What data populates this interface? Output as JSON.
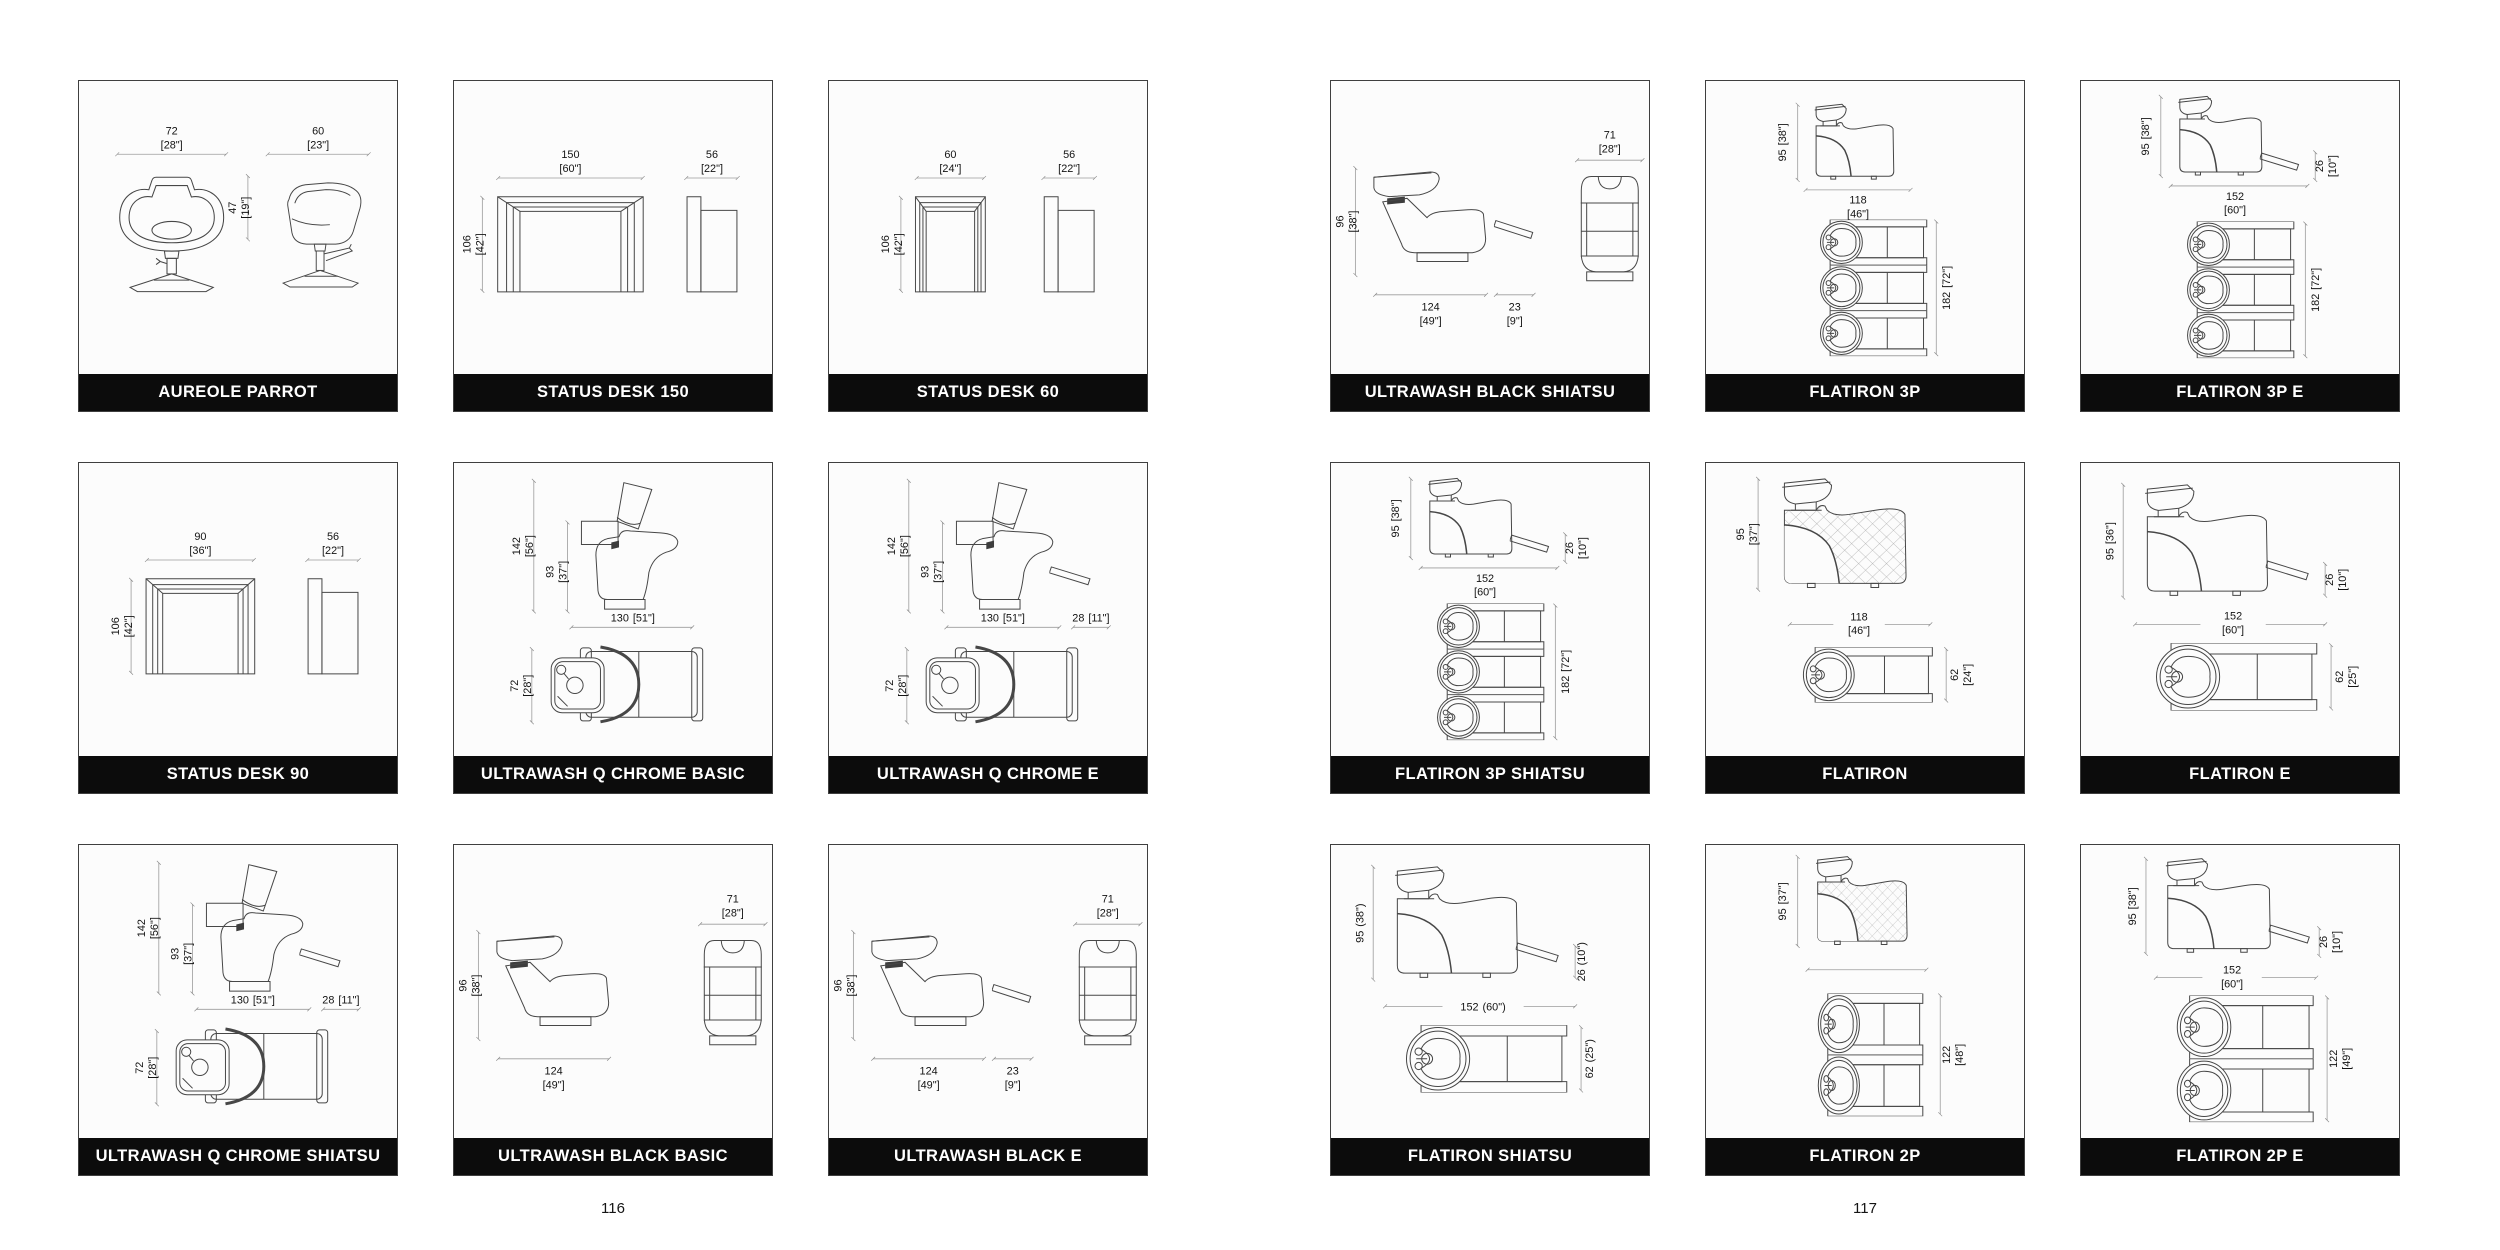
{
  "colors": {
    "title_bar": "#0c0c0c",
    "title_text": "#ffffff",
    "card_border": "#3f3f3f",
    "drawing_line": "#474747",
    "dimension_line": "#9b9b9b"
  },
  "pages": [
    {
      "page_number": "116",
      "cards": [
        {
          "title": "AUREOLE PARROT",
          "dims": {
            "d1": {
              "cm": "72",
              "in": "[28\"]"
            },
            "d2": {
              "cm": "60",
              "in": "[23\"]"
            },
            "d3": {
              "cm": "47",
              "in": "[19\"]"
            }
          }
        },
        {
          "title": "STATUS DESK 150",
          "dims": {
            "d1": {
              "cm": "150",
              "in": "[60\"]"
            },
            "d2": {
              "cm": "56",
              "in": "[22\"]"
            },
            "d3": {
              "cm": "106",
              "in": "[42\"]"
            }
          }
        },
        {
          "title": "STATUS DESK 60",
          "dims": {
            "d1": {
              "cm": "60",
              "in": "[24\"]"
            },
            "d2": {
              "cm": "56",
              "in": "[22\"]"
            },
            "d3": {
              "cm": "106",
              "in": "[42\"]"
            }
          }
        },
        {
          "title": "STATUS DESK 90",
          "dims": {
            "d1": {
              "cm": "90",
              "in": "[36\"]"
            },
            "d2": {
              "cm": "56",
              "in": "[22\"]"
            },
            "d3": {
              "cm": "106",
              "in": "[42\"]"
            }
          }
        },
        {
          "title": "ULTRAWASH Q CHROME BASIC",
          "dims": {
            "d1": {
              "cm": "142",
              "in": "[56\"]"
            },
            "d2": {
              "cm": "93",
              "in": "[37\"]"
            },
            "d3": {
              "cm": "130",
              "in": "[51\"]"
            },
            "d4": {
              "cm": "72",
              "in": "[28\"]"
            }
          }
        },
        {
          "title": "ULTRAWASH Q CHROME E",
          "dims": {
            "d1": {
              "cm": "142",
              "in": "[56\"]"
            },
            "d2": {
              "cm": "93",
              "in": "[37\"]"
            },
            "d3": {
              "cm": "130",
              "in": "[51\"]"
            },
            "d4": {
              "cm": "72",
              "in": "[28\"]"
            },
            "d5": {
              "cm": "28",
              "in": "[11\"]"
            }
          }
        },
        {
          "title": "ULTRAWASH Q CHROME SHIATSU",
          "dims": {
            "d1": {
              "cm": "142",
              "in": "[56\"]"
            },
            "d2": {
              "cm": "93",
              "in": "[37\"]"
            },
            "d3": {
              "cm": "130",
              "in": "[51\"]"
            },
            "d4": {
              "cm": "72",
              "in": "[28\"]"
            },
            "d5": {
              "cm": "28",
              "in": "[11\"]"
            }
          }
        },
        {
          "title": "ULTRAWASH BLACK BASIC",
          "dims": {
            "d1": {
              "cm": "96",
              "in": "[38\"]"
            },
            "d2": {
              "cm": "124",
              "in": "[49\"]"
            },
            "d3": {
              "cm": "71",
              "in": "[28\"]"
            }
          }
        },
        {
          "title": "ULTRAWASH BLACK E",
          "dims": {
            "d1": {
              "cm": "96",
              "in": "[38\"]"
            },
            "d2": {
              "cm": "124",
              "in": "[49\"]"
            },
            "d3": {
              "cm": "71",
              "in": "[28\"]"
            },
            "d4": {
              "cm": "23",
              "in": "[9\"]"
            }
          }
        }
      ]
    },
    {
      "page_number": "117",
      "cards": [
        {
          "title": "ULTRAWASH BLACK SHIATSU",
          "dims": {
            "d1": {
              "cm": "96",
              "in": "[38\"]"
            },
            "d2": {
              "cm": "124",
              "in": "[49\"]"
            },
            "d3": {
              "cm": "71",
              "in": "[28\"]"
            },
            "d4": {
              "cm": "23",
              "in": "[9\"]"
            }
          }
        },
        {
          "title": "FLATIRON 3P",
          "dims": {
            "d1": {
              "cm": "95",
              "in": "[38\"]"
            },
            "d2": {
              "cm": "118",
              "in": "[46\"]"
            },
            "d3": {
              "cm": "182",
              "in": "[72\"]"
            }
          }
        },
        {
          "title": "FLATIRON 3P E",
          "dims": {
            "d1": {
              "cm": "95",
              "in": "[38\"]"
            },
            "d2": {
              "cm": "152",
              "in": "[60\"]"
            },
            "d3": {
              "cm": "26",
              "in": "[10\"]"
            },
            "d4": {
              "cm": "182",
              "in": "[72\"]"
            }
          }
        },
        {
          "title": "FLATIRON 3P SHIATSU",
          "dims": {
            "d1": {
              "cm": "95",
              "in": "[38\"]"
            },
            "d2": {
              "cm": "152",
              "in": "[60\"]"
            },
            "d3": {
              "cm": "26",
              "in": "[10\"]"
            },
            "d4": {
              "cm": "182",
              "in": "[72\"]"
            }
          }
        },
        {
          "title": "FLATIRON",
          "dims": {
            "d1": {
              "cm": "95",
              "in": "[37\"]"
            },
            "d2": {
              "cm": "118",
              "in": "[46\"]"
            },
            "d3": {
              "cm": "62",
              "in": "[24\"]"
            }
          }
        },
        {
          "title": "FLATIRON E",
          "dims": {
            "d1": {
              "cm": "95",
              "in": "[36\"]"
            },
            "d2": {
              "cm": "152",
              "in": "[60\"]"
            },
            "d3": {
              "cm": "26",
              "in": "[10\"]"
            },
            "d4": {
              "cm": "62",
              "in": "[25\"]"
            }
          }
        },
        {
          "title": "FLATIRON SHIATSU",
          "dims": {
            "d1": {
              "cm": "95",
              "in": "(38\")"
            },
            "d2": {
              "cm": "152",
              "in": "(60\")"
            },
            "d3": {
              "cm": "26",
              "in": "(10\")"
            },
            "d4": {
              "cm": "62",
              "in": "(25\")"
            }
          }
        },
        {
          "title": "FLATIRON 2P",
          "dims": {
            "d1": {
              "cm": "95",
              "in": "[37\"]"
            },
            "d2": {
              "cm": "122",
              "in": "[48\"]"
            }
          }
        },
        {
          "title": "FLATIRON 2P E",
          "dims": {
            "d1": {
              "cm": "95",
              "in": "[38\"]"
            },
            "d2": {
              "cm": "152",
              "in": "[60\"]"
            },
            "d3": {
              "cm": "26",
              "in": "[10\"]"
            },
            "d4": {
              "cm": "122",
              "in": "[49\"]"
            }
          }
        }
      ]
    }
  ]
}
